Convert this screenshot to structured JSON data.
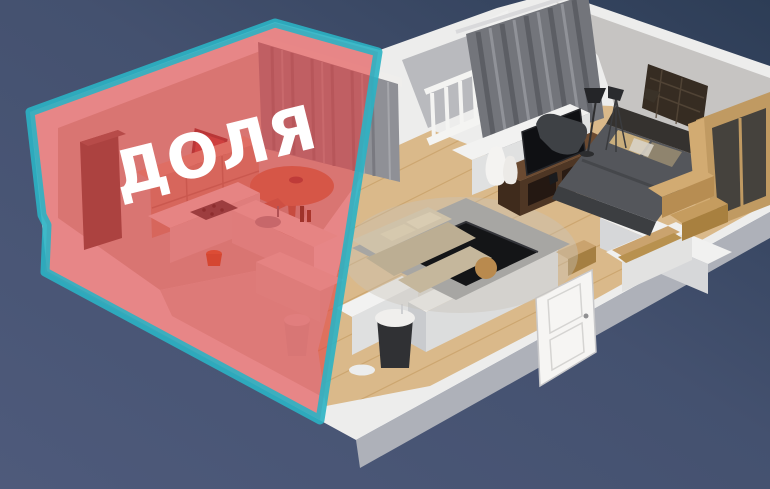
{
  "label": {
    "text": "ДОЛЯ",
    "color": "#ffffff"
  },
  "overlay": {
    "fill": "rgba(228,60,62,0.58)",
    "border": "#2bb3c4"
  },
  "palette": {
    "background_dark": "#2d3d56",
    "background_light": "#4e5a7b",
    "wall_top": "#ededec",
    "wall_side": "#aeb1b9",
    "interior_wall": "#c6c4c2",
    "floor_wood": "#dab98a",
    "plank_line": "#c8a269",
    "floor_carpet": "#cbc3ba",
    "curtain_gray": "#7d7f85",
    "sofa_beige": "#c9bca3",
    "tv_stand_wood": "#5a3f2c",
    "bed_blanket": "#54565b",
    "wardrobe_wood": "#c09a62",
    "sunken_table_glass": "#141517"
  }
}
